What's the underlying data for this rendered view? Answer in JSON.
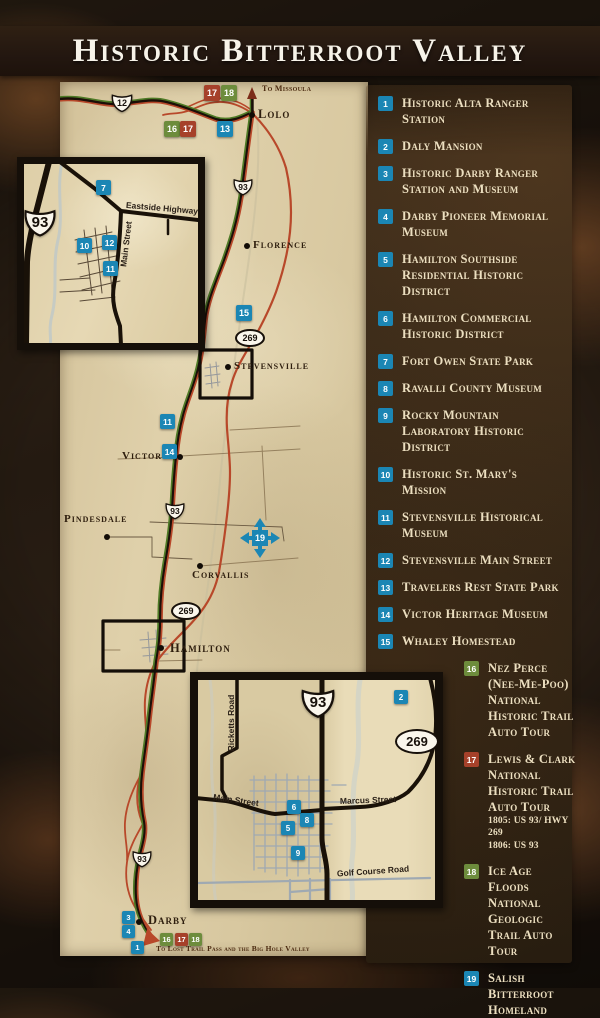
{
  "title": "Historic Bitterroot Valley",
  "colors": {
    "badge_blue": "#1b86b4",
    "badge_green": "#6d8c3c",
    "badge_red": "#a6412a",
    "trail_green": "#4e7a26",
    "trail_red": "#b8482a",
    "road_dark": "#1b0f08",
    "parchment": "#dccda5",
    "legend_panel": "#33261594",
    "legend_text": "#ecdfc0"
  },
  "legend": {
    "items": [
      {
        "num": "1",
        "color": "blue",
        "label": "Historic Alta Ranger Station"
      },
      {
        "num": "2",
        "color": "blue",
        "label": "Daly Mansion"
      },
      {
        "num": "3",
        "color": "blue",
        "label": "Historic Darby Ranger Station and Museum"
      },
      {
        "num": "4",
        "color": "blue",
        "label": "Darby Pioneer Memorial Museum"
      },
      {
        "num": "5",
        "color": "blue",
        "label": "Hamilton Southside Residential Historic District"
      },
      {
        "num": "6",
        "color": "blue",
        "label": "Hamilton Commercial Historic District"
      },
      {
        "num": "7",
        "color": "blue",
        "label": "Fort Owen State Park"
      },
      {
        "num": "8",
        "color": "blue",
        "label": "Ravalli County Museum"
      },
      {
        "num": "9",
        "color": "blue",
        "label": "Rocky Mountain Laboratory Historic District"
      },
      {
        "num": "10",
        "color": "blue",
        "label": "Historic St. Mary's Mission"
      },
      {
        "num": "11",
        "color": "blue",
        "label": "Stevensville Historical Museum"
      },
      {
        "num": "12",
        "color": "blue",
        "label": "Stevensville Main Street"
      },
      {
        "num": "13",
        "color": "blue",
        "label": "Travelers Rest State Park"
      },
      {
        "num": "14",
        "color": "blue",
        "label": "Victor Heritage Museum"
      },
      {
        "num": "15",
        "color": "blue",
        "label": "Whaley Homestead"
      },
      {
        "num": "16",
        "color": "green",
        "label": "Nez Perce (Nee-Me-Poo) National Historic Trail Auto Tour"
      },
      {
        "num": "17",
        "color": "red",
        "label": "Lewis & Clark National Historic Trail Auto Tour",
        "sub1": "1805: US 93/ HWY 269",
        "sub2": "1806: US 93"
      },
      {
        "num": "18",
        "color": "green",
        "label": "Ice Age Floods National Geologic Trail Auto Tour"
      },
      {
        "num": "19",
        "color": "blue",
        "label": "Salish Bitterroot Homeland"
      }
    ]
  },
  "map": {
    "towns": {
      "lolo": "Lolo",
      "florence": "Florence",
      "stevensville": "Stevensville",
      "victor": "Victor",
      "pindesdale": "Pindesdale",
      "corvallis": "Corvallis",
      "hamilton": "Hamilton",
      "darby": "Darby"
    },
    "directions": {
      "missoula": "To Missoula",
      "lost_trail": "To Lost Trail Pass and the Big Hole Valley"
    },
    "shields": {
      "us12": "12",
      "us93": "93",
      "mt269": "269"
    },
    "streets": {
      "eastside": "Eastside Highway",
      "main1": "Main Street",
      "ricketts": "Ricketts Road",
      "main2": "Main Street",
      "marcus": "Marcus Street",
      "golf": "Golf Course Road"
    },
    "marker_numbers": {
      "1": "1",
      "2": "2",
      "3": "3",
      "4": "4",
      "5": "5",
      "6": "6",
      "7": "7",
      "8": "8",
      "9": "9",
      "10": "10",
      "11": "11",
      "12": "12",
      "13": "13",
      "14": "14",
      "15": "15",
      "16": "16",
      "17": "17",
      "18": "18",
      "19": "19"
    }
  }
}
